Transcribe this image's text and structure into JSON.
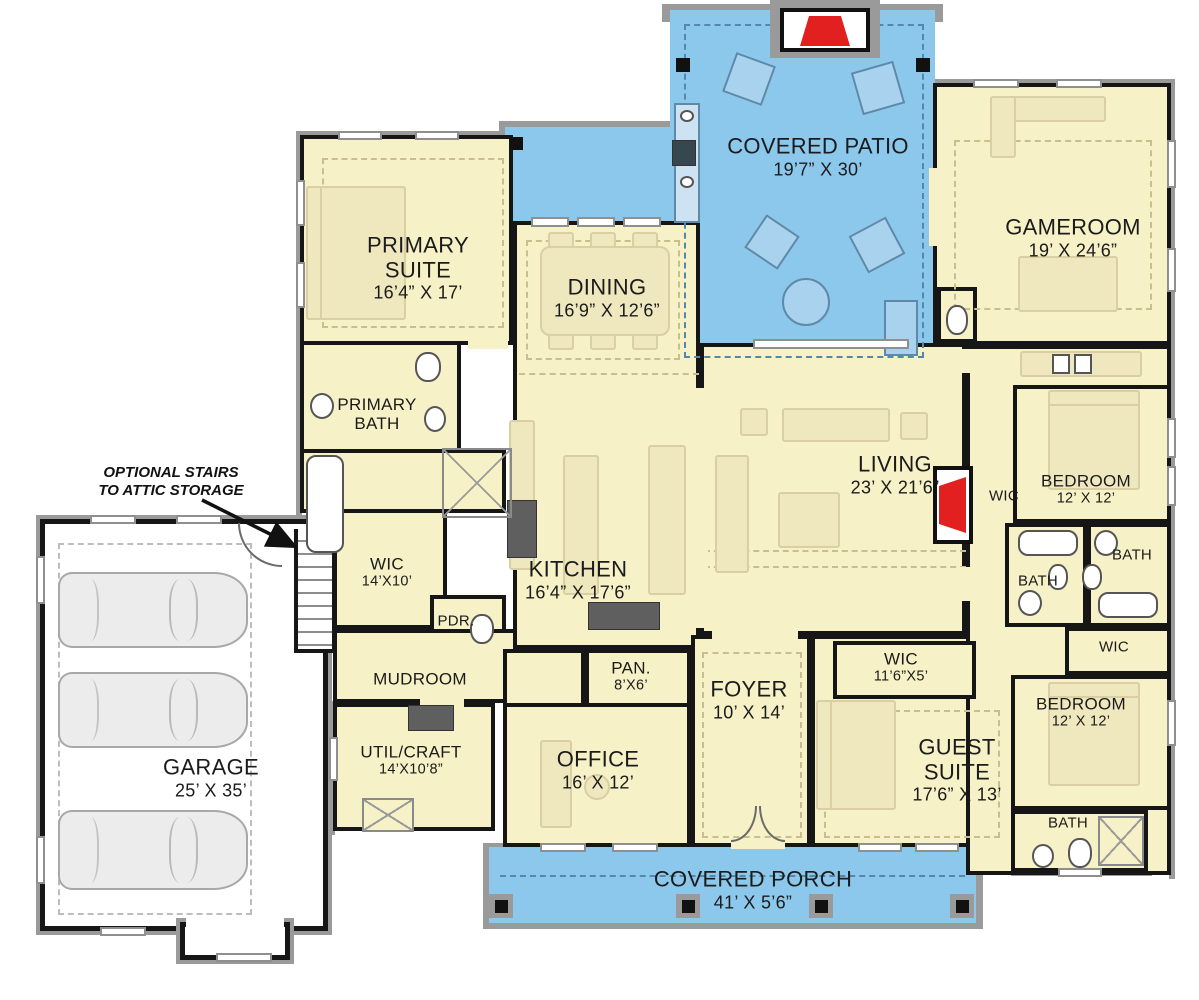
{
  "annotation": {
    "line1": "OPTIONAL STAIRS",
    "line2": "TO ATTIC STORAGE"
  },
  "rooms": {
    "covered_patio": {
      "name": "COVERED PATIO",
      "dims": "19’7” X 30’"
    },
    "gameroom": {
      "name": "GAMEROOM",
      "dims": "19’ X 24’6”"
    },
    "primary_suite": {
      "name": "PRIMARY SUITE",
      "dims": "16’4” X 17’"
    },
    "dining": {
      "name": "DINING",
      "dims": "16’9” X 12’6”"
    },
    "primary_bath": {
      "name": "PRIMARY BATH"
    },
    "living": {
      "name": "LIVING",
      "dims": "23’ X 21’6”"
    },
    "wic_living": {
      "name": "WIC"
    },
    "bedroom_top": {
      "name": "BEDROOM",
      "dims": "12’ X 12’"
    },
    "bath_right": {
      "name": "BATH"
    },
    "bath_left": {
      "name": "BATH"
    },
    "wic_bedroom": {
      "name": "WIC"
    },
    "wic_primary": {
      "name": "WIC",
      "dims": "14’X10’"
    },
    "kitchen": {
      "name": "KITCHEN",
      "dims": "16’4” X 17’6”"
    },
    "pdr": {
      "name": "PDR."
    },
    "mudroom": {
      "name": "MUDROOM"
    },
    "pantry": {
      "name": "PAN.",
      "dims": "8’X6’"
    },
    "foyer": {
      "name": "FOYER",
      "dims": "10’ X 14’"
    },
    "wic_guest": {
      "name": "WIC",
      "dims": "11’6”X5’"
    },
    "bedroom_bottom": {
      "name": "BEDROOM",
      "dims": "12’ X 12’"
    },
    "guest_suite": {
      "name": "GUEST SUITE",
      "dims": "17’6” X 13’"
    },
    "util_craft": {
      "name": "UTIL/CRAFT",
      "dims": "14’X10’8”"
    },
    "office": {
      "name": "OFFICE",
      "dims": "16’ X 12’"
    },
    "bath_bottom": {
      "name": "BATH"
    },
    "garage": {
      "name": "GARAGE",
      "dims": "25’ X 35’"
    },
    "covered_porch": {
      "name": "COVERED PORCH",
      "dims": "41’ X 5’6”"
    }
  },
  "colors": {
    "floor": "#f6f1c6",
    "patio_porch": "#8cc8ec",
    "interior_wall": "#161616",
    "outer_wall": "#9a9a9a",
    "fireplace_red": "#e32020",
    "garage_floor": "#ffffff"
  }
}
